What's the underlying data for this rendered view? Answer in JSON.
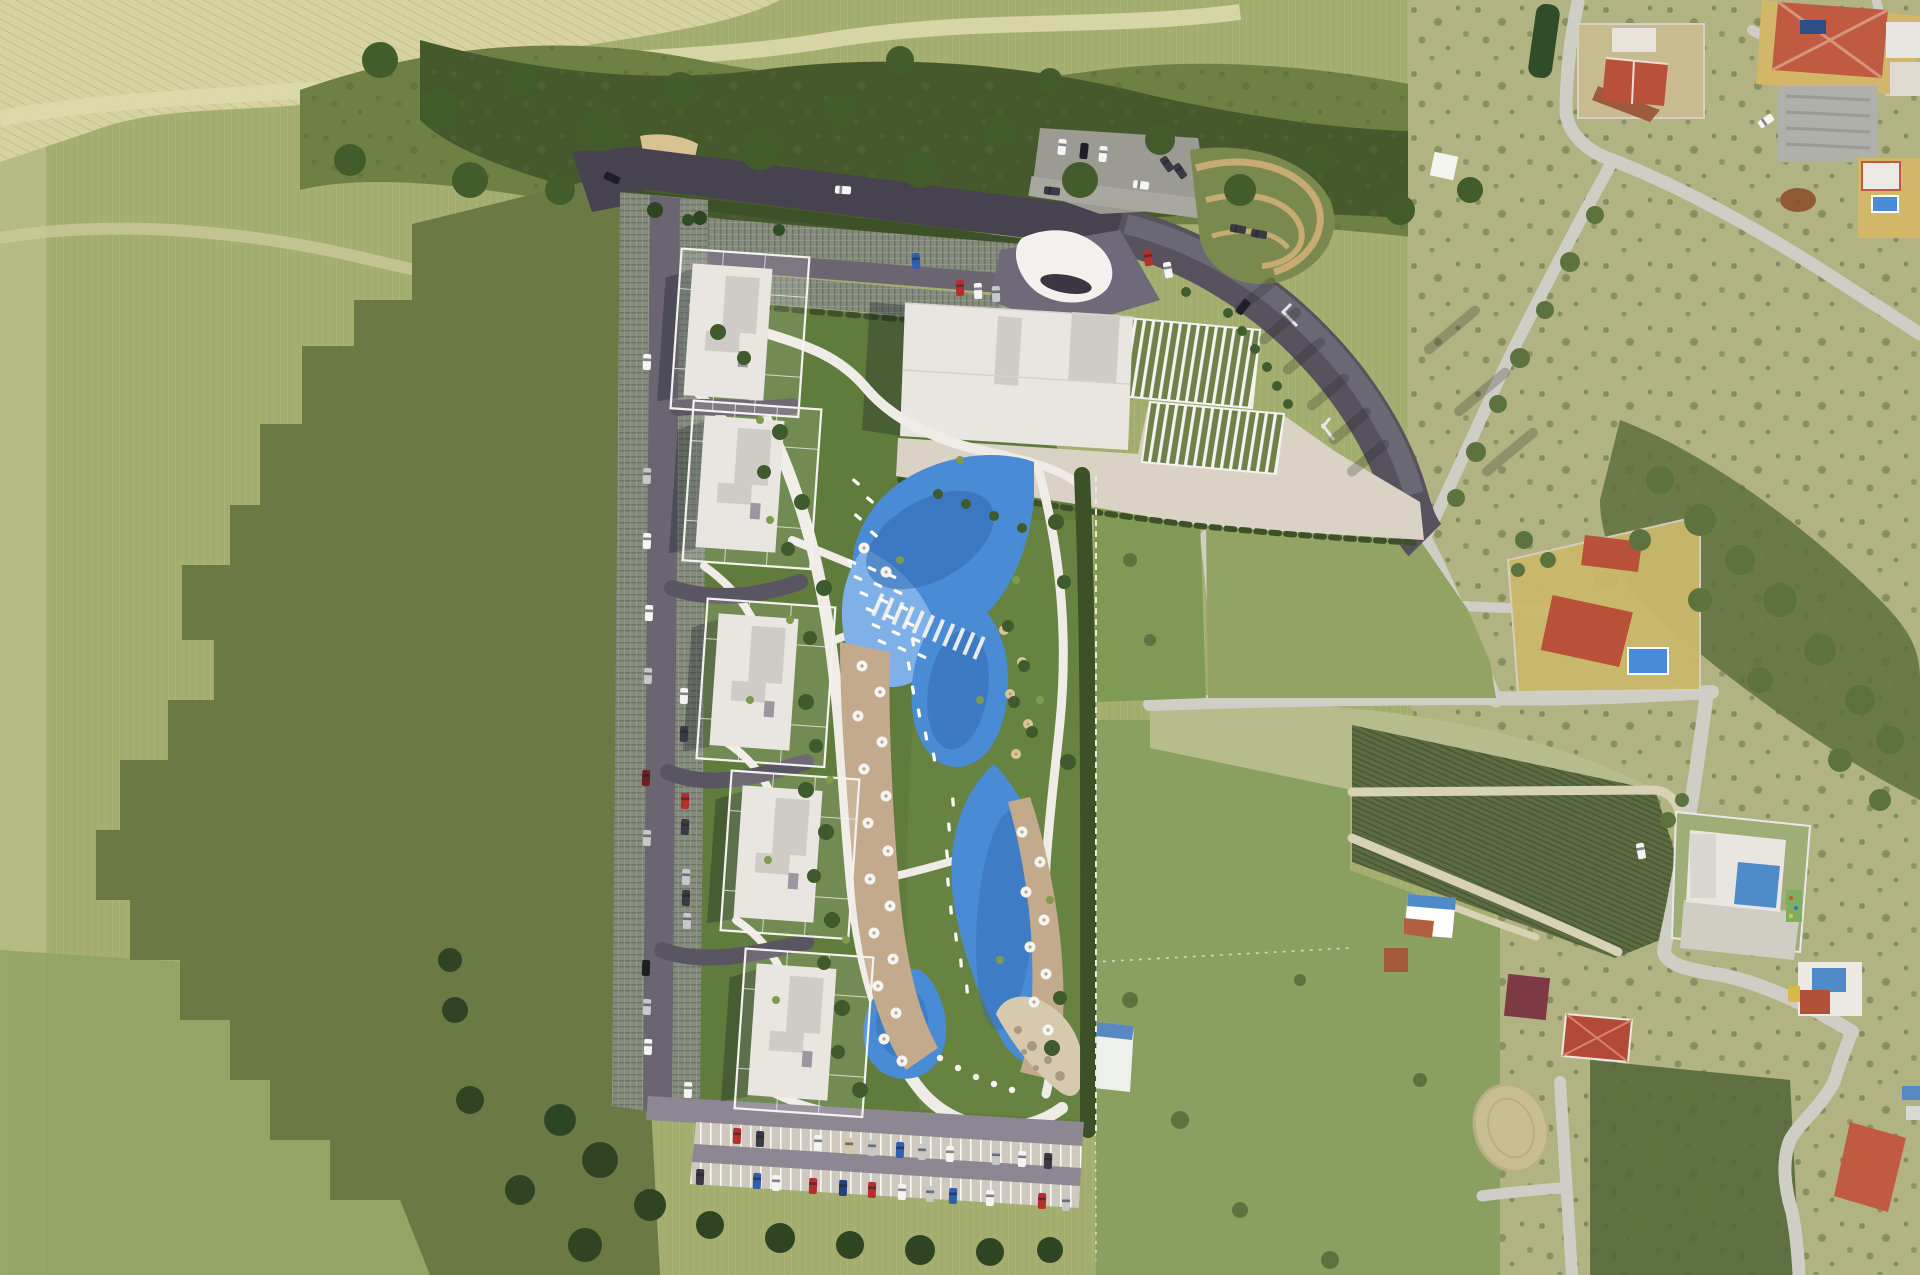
{
  "palette": {
    "field_olive": "#a3ad6e",
    "field_light_strip": "#b8bc85",
    "field_green_sw": "#8ea263",
    "wheat": "#d6d3a0",
    "wheat_line": "#c6c398",
    "track_pale": "#ddd9ab",
    "scrub_mid": "#6f8045",
    "scrub_dark": "#46592c",
    "terrain_tan": "#b2b383",
    "pasture": "#8aa061",
    "tilled_dark": "#5c6b41",
    "pale_strip": "#b7bc8c",
    "lawn_west": "#7e9a55",
    "lawn_east": "#93a363",
    "shadow_cast": "#6b7a45",
    "road_aerial": "#cfcec6",
    "road_render_dark": "#57525e",
    "road_render_light": "#6e6a79",
    "road_top_dark": "#474250",
    "parking_lot_gray": "#9b9a93",
    "deck_base": "#858c7e",
    "lane_gray": "#6b6572",
    "stall_beige": "#cfc8bf",
    "bottom_road": "#8d8793",
    "garden_green": "#5f7c3c",
    "garden_light": "#6d8a45",
    "hedge_dark": "#3c5128",
    "building_white": "#e9e6e2",
    "building_gray": "#cfccc7",
    "terrace_beige": "#dbd2c6",
    "canopy_white": "#f2f1ee",
    "pergola_green": "#6f8049",
    "sand_play": "#d8c291",
    "sand_path": "#c8ab72",
    "pool_blue": "#4a8bd6",
    "pool_deep": "#2e66ae",
    "pool_shallow": "#7fb1e8",
    "deck_tan": "#c3aa8c",
    "beach_sand": "#d6c9ae",
    "roof_red": "#b8503a",
    "roof_terracotta": "#c05a40",
    "roof_maroon": "#7e3a44",
    "roof_blue": "#4e8bc8",
    "yard_yellow": "#d2b768",
    "warehouse_gray": "#b0b0aa",
    "soil_brown": "#8a4a28",
    "car_white": "#f4f4f2",
    "car_black": "#1e1e24",
    "car_silver": "#c6c8ca",
    "car_dark": "#3a3a44",
    "car_red": "#b5302a",
    "car_blue": "#2f5fb0",
    "car_darkred": "#6e1f24",
    "car_darkblue": "#24407e",
    "car_tan": "#d6c8a4"
  },
  "site": {
    "apartment_building_count": 5,
    "pool_lobe_count": 4,
    "umbrella_count": 31,
    "visible_car_count": 61
  },
  "features": {
    "cars": [
      [
        843,
        190,
        4,
        "white"
      ],
      [
        916,
        261,
        86,
        "blue"
      ],
      [
        960,
        288,
        88,
        "red"
      ],
      [
        978,
        291,
        88,
        "white"
      ],
      [
        996,
        294,
        88,
        "silver"
      ],
      [
        1062,
        147,
        96,
        "white"
      ],
      [
        1084,
        151,
        96,
        "black"
      ],
      [
        1103,
        154,
        96,
        "white"
      ],
      [
        1167,
        164,
        55,
        "dark"
      ],
      [
        1180,
        171,
        55,
        "dark"
      ],
      [
        1141,
        185,
        8,
        "white"
      ],
      [
        1052,
        191,
        6,
        "dark"
      ],
      [
        1243,
        307,
        -52,
        "black"
      ],
      [
        1238,
        229,
        10,
        "dark"
      ],
      [
        1259,
        234,
        10,
        "dark"
      ],
      [
        612,
        178,
        25,
        "black"
      ],
      [
        1148,
        258,
        80,
        "red"
      ],
      [
        1168,
        270,
        80,
        "white"
      ],
      [
        647,
        362,
        92,
        "white"
      ],
      [
        647,
        476,
        92,
        "silver"
      ],
      [
        647,
        541,
        92,
        "white"
      ],
      [
        649,
        613,
        92,
        "white"
      ],
      [
        648,
        676,
        92,
        "silver"
      ],
      [
        646,
        778,
        92,
        "darkred"
      ],
      [
        647,
        838,
        92,
        "silver"
      ],
      [
        646,
        968,
        92,
        "black"
      ],
      [
        647,
        1007,
        92,
        "silver"
      ],
      [
        648,
        1047,
        92,
        "white"
      ],
      [
        684,
        696,
        92,
        "white"
      ],
      [
        684,
        734,
        92,
        "dark"
      ],
      [
        685,
        801,
        92,
        "red"
      ],
      [
        685,
        827,
        92,
        "dark"
      ],
      [
        686,
        877,
        92,
        "silver"
      ],
      [
        686,
        898,
        92,
        "dark"
      ],
      [
        687,
        921,
        92,
        "silver"
      ],
      [
        688,
        1090,
        92,
        "white"
      ],
      [
        737,
        1136,
        92,
        "red"
      ],
      [
        760,
        1139,
        92,
        "dark"
      ],
      [
        818,
        1143,
        92,
        "white"
      ],
      [
        849,
        1146,
        92,
        "tan"
      ],
      [
        872,
        1148,
        92,
        "silver"
      ],
      [
        900,
        1150,
        92,
        "blue"
      ],
      [
        922,
        1152,
        92,
        "silver"
      ],
      [
        950,
        1154,
        92,
        "white"
      ],
      [
        996,
        1157,
        92,
        "silver"
      ],
      [
        1022,
        1159,
        92,
        "white"
      ],
      [
        1048,
        1161,
        92,
        "dark"
      ],
      [
        700,
        1177,
        92,
        "dark"
      ],
      [
        757,
        1181,
        92,
        "blue"
      ],
      [
        776,
        1183,
        92,
        "white"
      ],
      [
        813,
        1186,
        92,
        "red"
      ],
      [
        843,
        1188,
        92,
        "darkblue"
      ],
      [
        872,
        1190,
        92,
        "red"
      ],
      [
        902,
        1192,
        92,
        "white"
      ],
      [
        930,
        1194,
        92,
        "silver"
      ],
      [
        953,
        1196,
        92,
        "blue"
      ],
      [
        990,
        1198,
        92,
        "white"
      ],
      [
        1042,
        1201,
        92,
        "red"
      ],
      [
        1066,
        1203,
        92,
        "silver"
      ],
      [
        1766,
        121,
        -35,
        "white"
      ],
      [
        1641,
        851,
        80,
        "white"
      ]
    ],
    "umbrellas": [
      [
        862,
        666
      ],
      [
        880,
        692
      ],
      [
        858,
        716
      ],
      [
        882,
        742
      ],
      [
        864,
        769
      ],
      [
        886,
        796
      ],
      [
        868,
        823
      ],
      [
        888,
        851
      ],
      [
        870,
        879
      ],
      [
        890,
        906
      ],
      [
        874,
        933
      ],
      [
        893,
        959
      ],
      [
        878,
        986
      ],
      [
        896,
        1013
      ],
      [
        884,
        1039
      ],
      [
        902,
        1061
      ],
      [
        1022,
        832
      ],
      [
        1040,
        862
      ],
      [
        1026,
        892
      ],
      [
        1044,
        920
      ],
      [
        1030,
        947
      ],
      [
        1046,
        974
      ],
      [
        1034,
        1002
      ],
      [
        1048,
        1030
      ],
      [
        864,
        548
      ],
      [
        886,
        572
      ]
    ],
    "umbrellas_tan": [
      [
        1004,
        630
      ],
      [
        1022,
        662
      ],
      [
        1010,
        694
      ],
      [
        1028,
        724
      ],
      [
        1016,
        754
      ]
    ],
    "loungers": [
      [
        852,
        562,
        25
      ],
      [
        872,
        569,
        25
      ],
      [
        892,
        576,
        25
      ],
      [
        858,
        578,
        25
      ],
      [
        878,
        585,
        25
      ],
      [
        898,
        592,
        25
      ],
      [
        864,
        594,
        25
      ],
      [
        884,
        601,
        25
      ],
      [
        904,
        608,
        25
      ],
      [
        870,
        610,
        25
      ],
      [
        890,
        617,
        25
      ],
      [
        910,
        624,
        25
      ],
      [
        876,
        626,
        25
      ],
      [
        896,
        633,
        25
      ],
      [
        916,
        640,
        25
      ],
      [
        882,
        642,
        25
      ],
      [
        902,
        649,
        25
      ],
      [
        922,
        656,
        25
      ],
      [
        856,
        482,
        40
      ],
      [
        870,
        500,
        40
      ],
      [
        858,
        517,
        40
      ],
      [
        874,
        534,
        40
      ],
      [
        913,
        642,
        80
      ],
      [
        909,
        666,
        80
      ],
      [
        913,
        690,
        80
      ],
      [
        919,
        713,
        80
      ],
      [
        926,
        736,
        80
      ],
      [
        934,
        757,
        80
      ],
      [
        953,
        802,
        85
      ],
      [
        949,
        827,
        85
      ],
      [
        947,
        854,
        85
      ],
      [
        948,
        882,
        85
      ],
      [
        951,
        910,
        85
      ],
      [
        956,
        937,
        85
      ],
      [
        961,
        963,
        85
      ],
      [
        967,
        989,
        85
      ]
    ],
    "pool_dots": [
      [
        940,
        1058
      ],
      [
        958,
        1068
      ],
      [
        976,
        1077
      ],
      [
        994,
        1084
      ],
      [
        1012,
        1090
      ]
    ],
    "rocks": [
      [
        1018,
        1030,
        4
      ],
      [
        1032,
        1046,
        5
      ],
      [
        1048,
        1060,
        4
      ],
      [
        1060,
        1076,
        5
      ],
      [
        1036,
        1068,
        3
      ],
      [
        1024,
        1052,
        3
      ]
    ],
    "trees": [
      [
        718,
        332,
        8,
        "g"
      ],
      [
        744,
        358,
        7,
        "g"
      ],
      [
        780,
        432,
        8,
        "g"
      ],
      [
        764,
        472,
        7,
        "g"
      ],
      [
        802,
        502,
        8,
        "g"
      ],
      [
        788,
        549,
        7,
        "g"
      ],
      [
        824,
        588,
        8,
        "g"
      ],
      [
        810,
        638,
        7,
        "g"
      ],
      [
        806,
        702,
        8,
        "g"
      ],
      [
        816,
        746,
        7,
        "g"
      ],
      [
        806,
        790,
        8,
        "g"
      ],
      [
        826,
        832,
        8,
        "g"
      ],
      [
        814,
        876,
        7,
        "g"
      ],
      [
        832,
        920,
        8,
        "g"
      ],
      [
        824,
        963,
        7,
        "g"
      ],
      [
        842,
        1008,
        8,
        "g"
      ],
      [
        838,
        1052,
        7,
        "g"
      ],
      [
        860,
        1090,
        8,
        "g"
      ],
      [
        1056,
        522,
        8,
        "g"
      ],
      [
        1064,
        582,
        7,
        "g"
      ],
      [
        1068,
        762,
        8,
        "g"
      ],
      [
        1060,
        998,
        7,
        "g"
      ],
      [
        1052,
        1048,
        8,
        "g"
      ],
      [
        1008,
        626,
        6,
        "g"
      ],
      [
        1024,
        666,
        6,
        "g"
      ],
      [
        1014,
        702,
        6,
        "g"
      ],
      [
        1032,
        732,
        6,
        "g"
      ],
      [
        938,
        494,
        5,
        "g"
      ],
      [
        966,
        504,
        5,
        "g"
      ],
      [
        994,
        516,
        5,
        "g"
      ],
      [
        1022,
        528,
        5,
        "g"
      ],
      [
        560,
        1120,
        16,
        "s"
      ],
      [
        600,
        1160,
        18,
        "s"
      ],
      [
        650,
        1205,
        16,
        "s"
      ],
      [
        710,
        1225,
        14,
        "s"
      ],
      [
        780,
        1238,
        15,
        "s"
      ],
      [
        850,
        1245,
        14,
        "s"
      ],
      [
        920,
        1250,
        15,
        "s"
      ],
      [
        990,
        1252,
        14,
        "s"
      ],
      [
        1050,
        1250,
        13,
        "s"
      ],
      [
        585,
        1245,
        17,
        "s"
      ],
      [
        520,
        1190,
        15,
        "s"
      ],
      [
        470,
        1100,
        14,
        "s"
      ],
      [
        455,
        1010,
        13,
        "s"
      ],
      [
        450,
        960,
        12,
        "s"
      ],
      [
        655,
        210,
        8,
        "s"
      ],
      [
        700,
        218,
        7,
        "s"
      ],
      [
        1595,
        215,
        9,
        "r"
      ],
      [
        1570,
        262,
        10,
        "r"
      ],
      [
        1545,
        310,
        9,
        "r"
      ],
      [
        1520,
        358,
        10,
        "r"
      ],
      [
        1498,
        404,
        9,
        "r"
      ],
      [
        1476,
        452,
        10,
        "r"
      ],
      [
        1456,
        498,
        9,
        "r"
      ],
      [
        1524,
        540,
        9,
        "r"
      ],
      [
        1548,
        560,
        8,
        "r"
      ],
      [
        1518,
        570,
        7,
        "r"
      ],
      [
        1130,
        560,
        7,
        "r"
      ],
      [
        1150,
        640,
        6,
        "r"
      ],
      [
        1668,
        820,
        8,
        "r"
      ],
      [
        1682,
        800,
        7,
        "r"
      ],
      [
        1130,
        1000,
        8,
        "r"
      ],
      [
        1180,
        1120,
        9,
        "r"
      ],
      [
        1240,
        1210,
        8,
        "r"
      ],
      [
        1330,
        1260,
        9,
        "r"
      ],
      [
        1420,
        1080,
        7,
        "r"
      ],
      [
        1300,
        980,
        6,
        "r"
      ],
      [
        1660,
        480,
        14,
        "r"
      ],
      [
        1700,
        520,
        16,
        "r"
      ],
      [
        1740,
        560,
        15,
        "r"
      ],
      [
        1780,
        600,
        17,
        "r"
      ],
      [
        1820,
        650,
        16,
        "r"
      ],
      [
        1860,
        700,
        15,
        "r"
      ],
      [
        1890,
        740,
        14,
        "r"
      ],
      [
        1700,
        600,
        12,
        "r"
      ],
      [
        1760,
        680,
        13,
        "r"
      ],
      [
        1640,
        540,
        11,
        "r"
      ],
      [
        1840,
        760,
        12,
        "r"
      ],
      [
        1880,
        800,
        11,
        "r"
      ],
      [
        1620,
        1100,
        15,
        "r"
      ],
      [
        1660,
        1150,
        17,
        "r"
      ],
      [
        1700,
        1200,
        16,
        "r"
      ],
      [
        1640,
        1230,
        14,
        "r"
      ],
      [
        1740,
        1120,
        13,
        "r"
      ],
      [
        1760,
        1240,
        12,
        "r"
      ],
      [
        1690,
        1090,
        12,
        "r"
      ],
      [
        380,
        60,
        18,
        "t"
      ],
      [
        440,
        110,
        20,
        "t"
      ],
      [
        520,
        80,
        16,
        "t"
      ],
      [
        600,
        130,
        22,
        "t"
      ],
      [
        680,
        90,
        18,
        "t"
      ],
      [
        760,
        150,
        20,
        "t"
      ],
      [
        840,
        110,
        16,
        "t"
      ],
      [
        920,
        170,
        18,
        "t"
      ],
      [
        1000,
        130,
        16,
        "t"
      ],
      [
        1080,
        180,
        18,
        "t"
      ],
      [
        1160,
        140,
        15,
        "t"
      ],
      [
        1240,
        190,
        16,
        "t"
      ],
      [
        1320,
        160,
        14,
        "t"
      ],
      [
        1400,
        210,
        15,
        "t"
      ],
      [
        1470,
        190,
        13,
        "t"
      ],
      [
        350,
        160,
        16,
        "t"
      ],
      [
        470,
        180,
        18,
        "t"
      ],
      [
        560,
        190,
        15,
        "t"
      ],
      [
        900,
        60,
        14,
        "t"
      ],
      [
        1050,
        80,
        12,
        "t"
      ],
      [
        688,
        220,
        6,
        "p"
      ],
      [
        779,
        230,
        6,
        "p"
      ],
      [
        1228,
        313,
        5,
        "q"
      ],
      [
        1242,
        331,
        5,
        "q"
      ],
      [
        1255,
        349,
        5,
        "q"
      ],
      [
        1267,
        367,
        5,
        "q"
      ],
      [
        1277,
        386,
        5,
        "q"
      ],
      [
        1288,
        404,
        5,
        "q"
      ],
      [
        1186,
        292,
        5,
        "q"
      ]
    ],
    "tufts": [
      [
        760,
        420
      ],
      [
        790,
        620
      ],
      [
        830,
        780
      ],
      [
        846,
        940
      ],
      [
        900,
        560
      ],
      [
        1040,
        700
      ],
      [
        1050,
        900
      ],
      [
        980,
        700
      ],
      [
        1000,
        960
      ],
      [
        770,
        520
      ],
      [
        750,
        700
      ],
      [
        768,
        860
      ],
      [
        776,
        1000
      ],
      [
        960,
        460
      ],
      [
        1016,
        580
      ]
    ],
    "palm_shadows": [
      [
        1255,
        296,
        -40,
        52
      ],
      [
        1280,
        326,
        -40,
        52
      ],
      [
        1304,
        356,
        -40,
        52
      ],
      [
        1328,
        392,
        -40,
        52
      ],
      [
        1350,
        426,
        -40,
        52
      ],
      [
        1368,
        458,
        -40,
        52
      ],
      [
        1452,
        330,
        -40,
        70
      ],
      [
        1482,
        392,
        -40,
        70
      ],
      [
        1510,
        452,
        -40,
        70
      ]
    ]
  }
}
